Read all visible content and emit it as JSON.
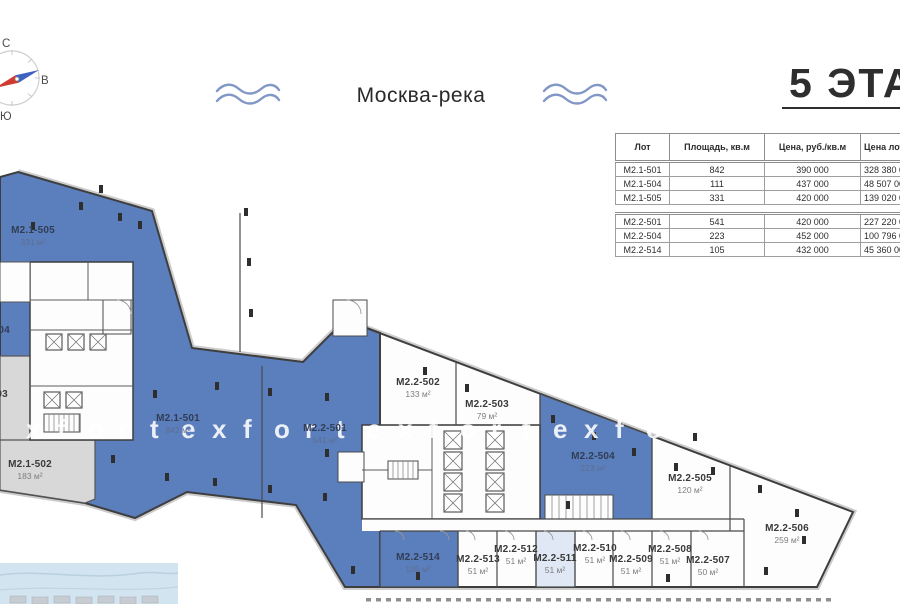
{
  "title": {
    "text": "5 ЭТАЖ"
  },
  "compass": {
    "north_label": "С",
    "east_label": "В",
    "south_label": "Ю"
  },
  "river": {
    "label": "Москва-река"
  },
  "watermark": {
    "text": "xfortexfortexfortexfortexfor"
  },
  "colors": {
    "unit_blue": "#5b7ebd",
    "unit_light_blue": "#dfe8f4",
    "unit_gray": "#d8d8d8",
    "wall": "#3e3e3e",
    "water": "#d2e4ef",
    "wave": "#8197c5",
    "needle_blue": "#3f62c1",
    "needle_red": "#d03b2f"
  },
  "price_table": {
    "headers": [
      "Лот",
      "Площадь, кв.м",
      "Цена, руб./кв.м",
      "Цена лота, руб."
    ],
    "sections": [
      {
        "rows": [
          [
            "М2.1-501",
            "842",
            "390 000",
            "328 380 000"
          ],
          [
            "М2.1-504",
            "111",
            "437 000",
            "48 507 000"
          ],
          [
            "М2.1-505",
            "331",
            "420 000",
            "139 020 000"
          ]
        ]
      },
      {
        "rows": [
          [
            "М2.2-501",
            "541",
            "420 000",
            "227 220 000"
          ],
          [
            "М2.2-504",
            "223",
            "452 000",
            "100 796 000"
          ],
          [
            "М2.2-514",
            "105",
            "432 000",
            "45 360 000"
          ]
        ]
      }
    ]
  },
  "plan": {
    "units": [
      {
        "id": "М2.1-505",
        "area": "331 м²",
        "x": 33,
        "y": 236,
        "on": "blue"
      },
      {
        "id": "М2.1-504",
        "area": "111 м²",
        "x": -12,
        "y": 336,
        "on": "blue"
      },
      {
        "id": "М2.1-503",
        "area": "м²",
        "x": -14,
        "y": 400,
        "on": "light"
      },
      {
        "id": "М2.1-502",
        "area": "183 м²",
        "x": 30,
        "y": 470,
        "on": "light"
      },
      {
        "id": "М2.1-501",
        "area": "842 м²",
        "x": 178,
        "y": 424,
        "on": "blue"
      },
      {
        "id": "М2.2-501",
        "area": "541 м²",
        "x": 325,
        "y": 434,
        "on": "blue"
      },
      {
        "id": "М2.2-502",
        "area": "133 м²",
        "x": 418,
        "y": 388,
        "on": "light"
      },
      {
        "id": "М2.2-503",
        "area": "79 м²",
        "x": 487,
        "y": 410,
        "on": "light"
      },
      {
        "id": "М2.2-504",
        "area": "223 м²",
        "x": 593,
        "y": 462,
        "on": "blue"
      },
      {
        "id": "М2.2-505",
        "area": "120 м²",
        "x": 690,
        "y": 484,
        "on": "light"
      },
      {
        "id": "М2.2-506",
        "area": "259 м²",
        "x": 787,
        "y": 534,
        "on": "light"
      },
      {
        "id": "М2.2-507",
        "area": "50 м²",
        "x": 708,
        "y": 566,
        "on": "light"
      },
      {
        "id": "М2.2-508",
        "area": "51 м²",
        "x": 670,
        "y": 555,
        "on": "light"
      },
      {
        "id": "М2.2-509",
        "area": "51 м²",
        "x": 631,
        "y": 565,
        "on": "light"
      },
      {
        "id": "М2.2-510",
        "area": "51 м²",
        "x": 595,
        "y": 554,
        "on": "light"
      },
      {
        "id": "М2.2-511",
        "area": "51 м²",
        "x": 555,
        "y": 564,
        "on": "light"
      },
      {
        "id": "М2.2-512",
        "area": "51 м²",
        "x": 516,
        "y": 555,
        "on": "light"
      },
      {
        "id": "М2.2-513",
        "area": "51 м²",
        "x": 478,
        "y": 565,
        "on": "light"
      },
      {
        "id": "М2.2-514",
        "area": "105 м²",
        "x": 418,
        "y": 563,
        "on": "blue"
      }
    ],
    "columns": [
      [
        101,
        189
      ],
      [
        81,
        206
      ],
      [
        120,
        217
      ],
      [
        140,
        225
      ],
      [
        33,
        226
      ],
      [
        246,
        212
      ],
      [
        249,
        262
      ],
      [
        251,
        313
      ],
      [
        155,
        394
      ],
      [
        217,
        386
      ],
      [
        270,
        392
      ],
      [
        327,
        397
      ],
      [
        113,
        459
      ],
      [
        167,
        477
      ],
      [
        215,
        482
      ],
      [
        270,
        489
      ],
      [
        325,
        497
      ],
      [
        327,
        453
      ],
      [
        353,
        570
      ],
      [
        418,
        576
      ],
      [
        425,
        371
      ],
      [
        467,
        388
      ],
      [
        553,
        419
      ],
      [
        568,
        505
      ],
      [
        594,
        436
      ],
      [
        634,
        452
      ],
      [
        676,
        467
      ],
      [
        695,
        437
      ],
      [
        713,
        471
      ],
      [
        760,
        489
      ],
      [
        797,
        513
      ],
      [
        766,
        571
      ],
      [
        804,
        540
      ],
      [
        668,
        578
      ]
    ]
  }
}
